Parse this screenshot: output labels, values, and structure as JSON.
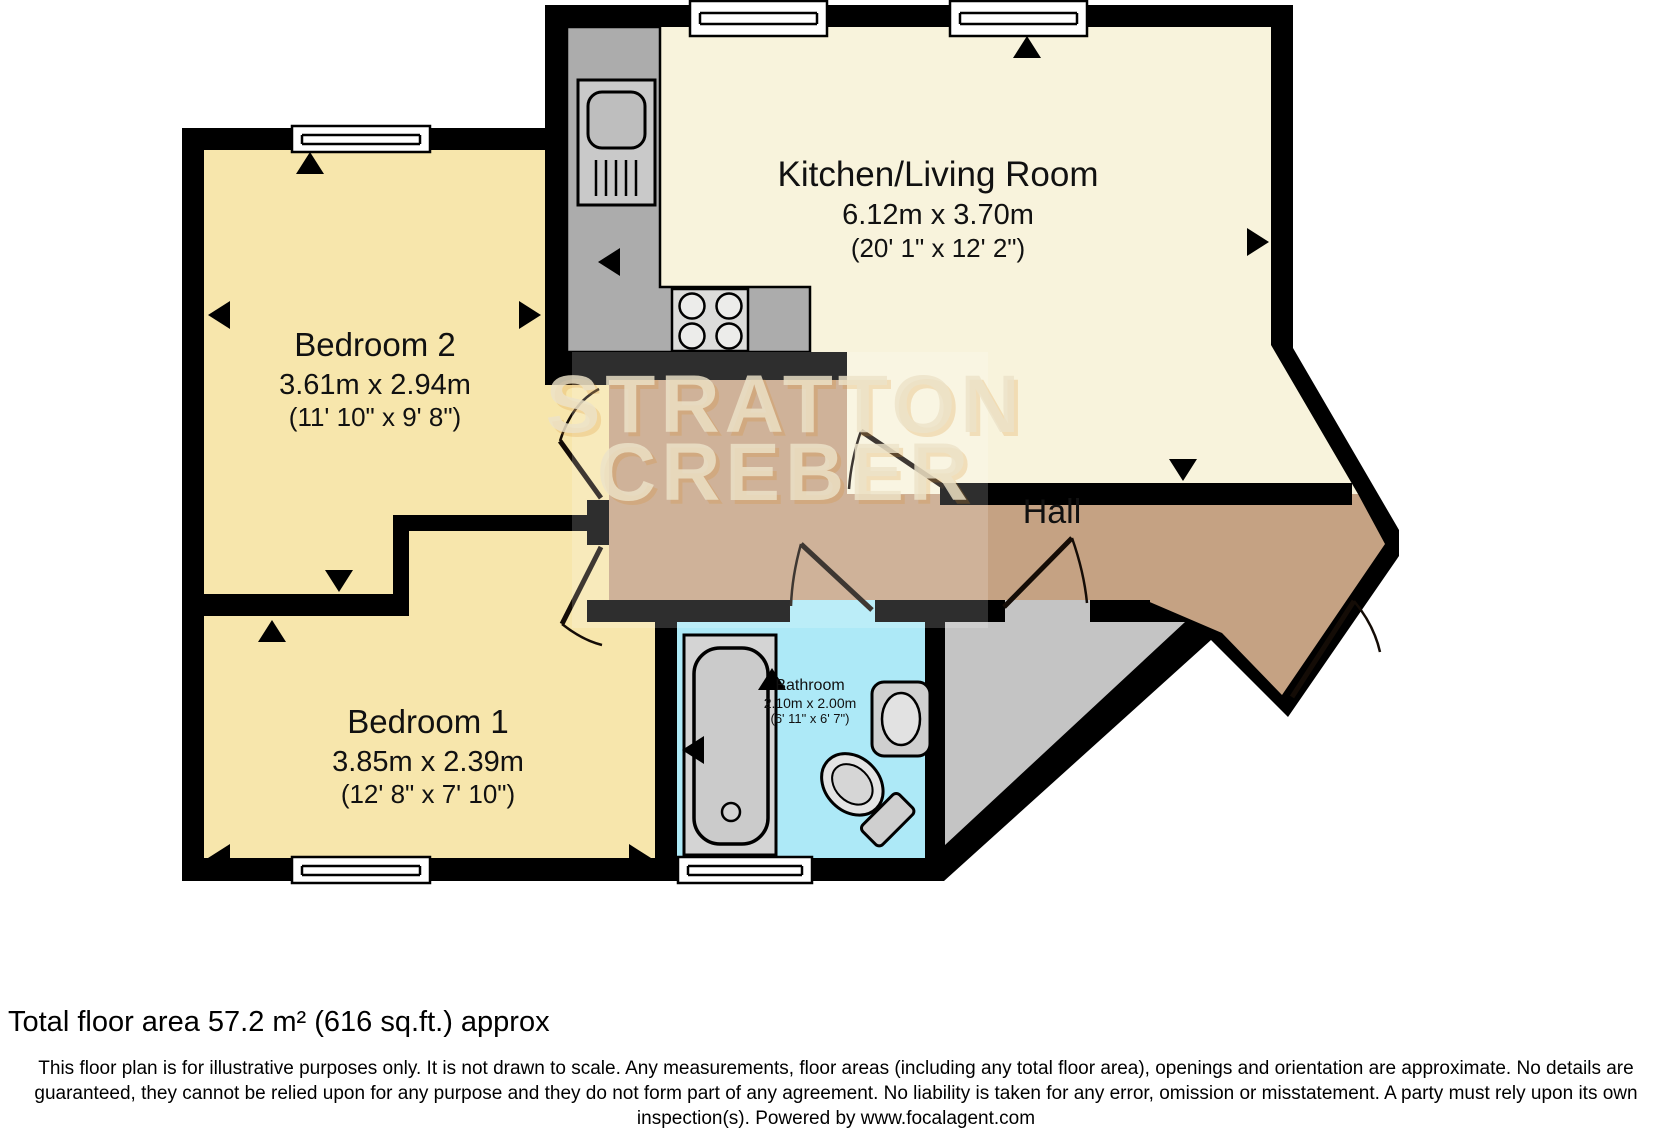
{
  "plan": {
    "watermark": {
      "line1": "STRATTON",
      "line2": "CREBER"
    },
    "rooms": [
      {
        "name": "Kitchen/Living Room",
        "dim_metric": "6.12m x 3.70m",
        "dim_imperial": "(20' 1\" x 12' 2\")"
      },
      {
        "name": "Bedroom 2",
        "dim_metric": "3.61m x 2.94m",
        "dim_imperial": "(11' 10\" x 9' 8\")"
      },
      {
        "name": "Bedroom 1",
        "dim_metric": "3.85m x 2.39m",
        "dim_imperial": "(12' 8\" x 7' 10\")"
      },
      {
        "name": "Hall"
      },
      {
        "name": "Bathroom",
        "dim_metric": "2.10m x 2.00m",
        "dim_imperial": "(6' 11\" x 6' 7\")"
      }
    ],
    "fixtures": [
      "kitchen-sink",
      "hob",
      "bathtub",
      "wash-basin",
      "toilet"
    ],
    "colors": {
      "wall": "#000000",
      "bedroom": "#F7E6AC",
      "kitchen_living": "#F8F3DC",
      "hall": "#C5A283",
      "bathroom": "#ADE9F7",
      "storage": "#C4C4C4",
      "counter": "#ACACAC",
      "window": "#FFFFFF"
    }
  },
  "footer": {
    "total_area": "Total floor area 57.2 m² (616 sq.ft.) approx",
    "disclaimer": "This floor plan is for illustrative purposes only. It is not drawn to scale. Any measurements, floor areas (including any total floor area), openings and orientation are approximate. No details are guaranteed, they cannot be relied upon for any purpose and they do not form part of any agreement. No liability is taken for any error, omission or misstatement. A party must rely upon its own inspection(s). Powered by www.focalagent.com"
  }
}
